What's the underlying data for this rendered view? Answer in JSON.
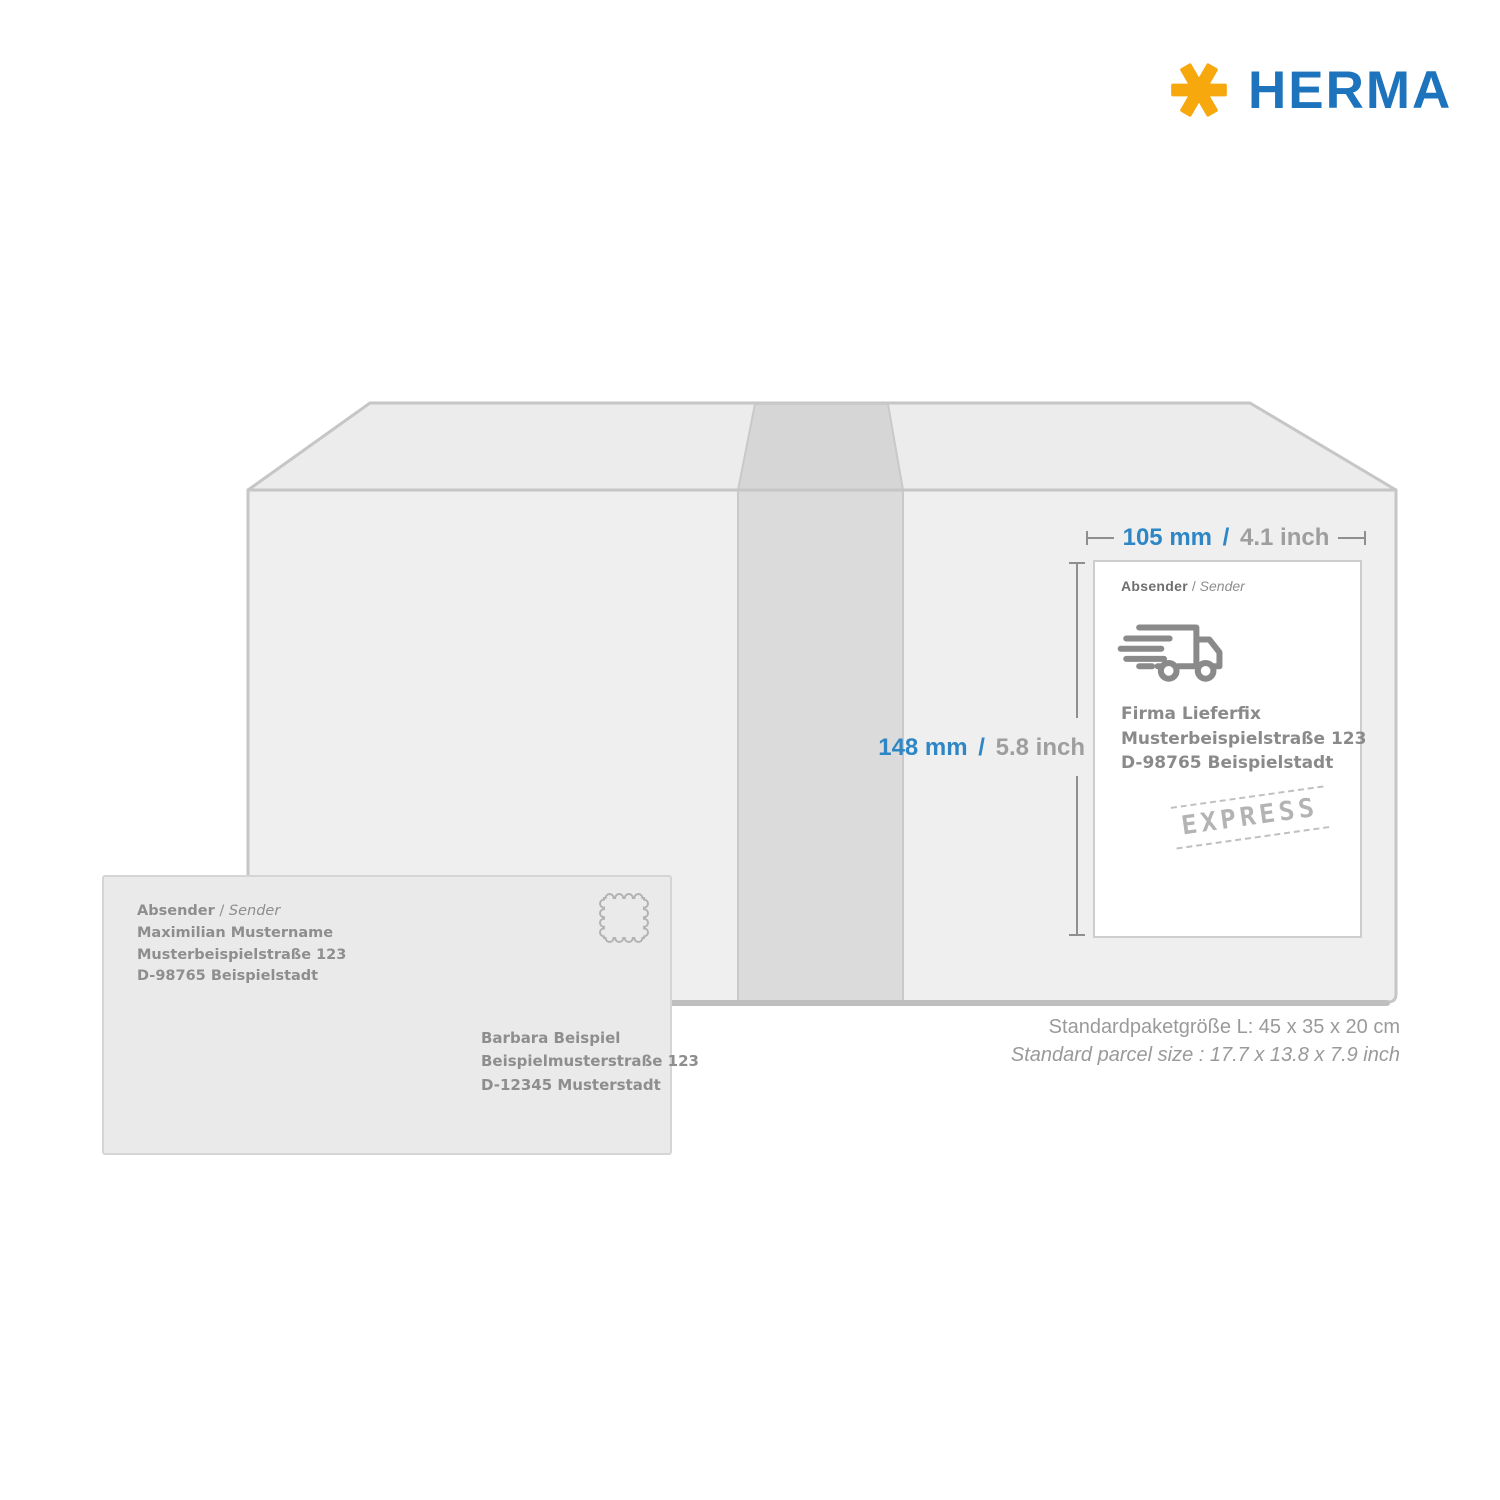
{
  "logo": {
    "text": "HERMA",
    "asterisk_icon": "herma-asterisk",
    "colors": {
      "asterisk": "#F7A80D",
      "wordmark": "#1E74BC"
    }
  },
  "measurements": {
    "accent_color": "#2E86C5",
    "width": {
      "metric": "105 mm",
      "separator": "/",
      "imperial": "4.1 inch"
    },
    "height": {
      "metric": "148 mm",
      "separator": "/",
      "imperial": "5.8 inch"
    }
  },
  "parcel_label": {
    "header": {
      "primary": "Absender",
      "separator": " / ",
      "secondary": "Sender"
    },
    "truck_icon": "delivery-truck",
    "address_lines": [
      "Firma Lieferfix",
      "Musterbeispielstraße 123",
      "D-98765 Beispielstadt"
    ],
    "stamp": "EXPRESS"
  },
  "envelope": {
    "sender_header": {
      "primary": "Absender",
      "separator": " / ",
      "secondary": "Sender"
    },
    "sender_lines": [
      "Maximilian Mustername",
      "Musterbeispielstraße 123",
      "D-98765 Beispielstadt"
    ],
    "recipient_lines": [
      "Barbara Beispiel",
      "Beispielmusterstraße 123",
      "D-12345 Musterstadt"
    ],
    "stamp_icon": "postage-stamp"
  },
  "caption": {
    "line1": "Standardpaketgröße L: 45 x 35 x 20 cm",
    "line2": "Standard parcel size : 17.7 x 13.8 x 7.9 inch"
  }
}
